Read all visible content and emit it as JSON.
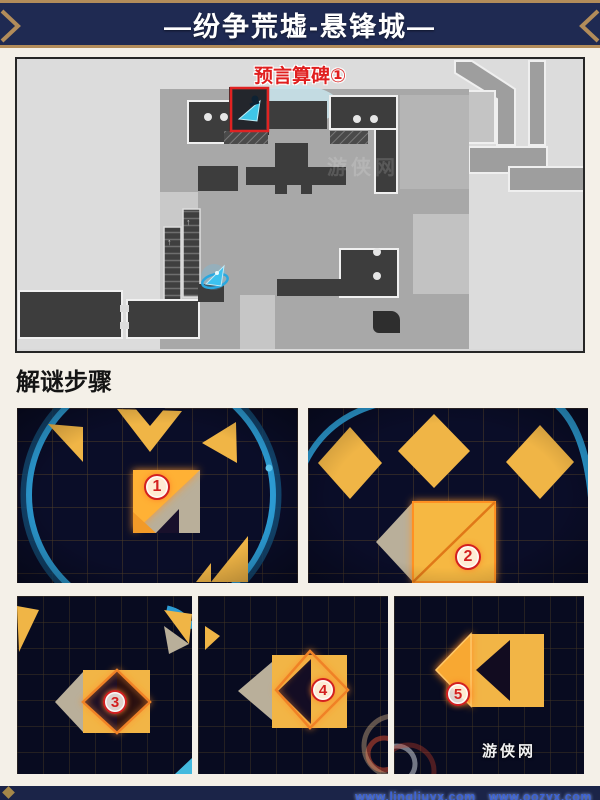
{
  "header": {
    "title": "—纷争荒墟-悬锋城—",
    "bg_color": "#1f2a52",
    "border_color": "#b28c5a"
  },
  "map": {
    "marker_label": "预言算碑①",
    "label_color": "#e01f1f"
  },
  "section": {
    "title": "解谜步骤"
  },
  "puzzles": [
    {
      "id": "step-1",
      "step": "1"
    },
    {
      "id": "step-2",
      "step": "2"
    },
    {
      "id": "step-3",
      "step": "3"
    },
    {
      "id": "step-4",
      "step": "4"
    },
    {
      "id": "step-5",
      "step": "5"
    }
  ],
  "footer": {
    "watermark_urls": "www.lingliuyx.com　www.oozyx.com",
    "logo_text": "游侠网"
  },
  "colors": {
    "accent_red": "#d32020",
    "puzzle_bg": "#0a0d28",
    "tile_yellow": "#f0b546",
    "tile_glow_orange": "#ffb136",
    "tile_gray": "#b9af9a",
    "ring_blue": "#2c9bd3"
  }
}
